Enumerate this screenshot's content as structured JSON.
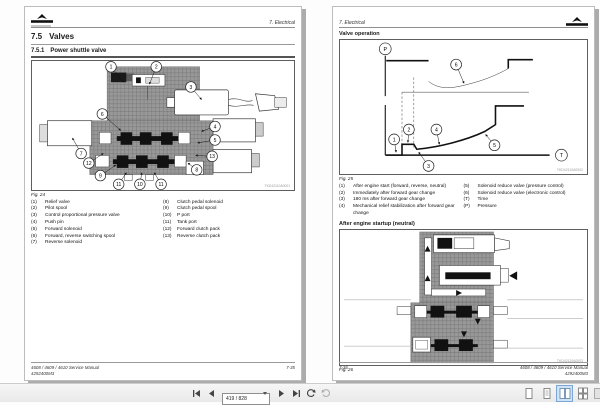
{
  "toolbar": {
    "page_input": "419 / 828"
  },
  "left_page": {
    "header": "7. Electrical",
    "section_num": "7.5",
    "section_title": "Valves",
    "subsection_num": "7.5.1",
    "subsection_title": "Power shuttle valve",
    "figure": {
      "caption": "Fig. 24",
      "drawing_id": "TKD42110A0001",
      "callouts": [
        "1",
        "2",
        "3",
        "4",
        "5",
        "6",
        "7",
        "8",
        "9",
        "10",
        "11",
        "12",
        "13"
      ]
    },
    "legend_left": [
      {
        "num": "(1)",
        "text": "Relief valve"
      },
      {
        "num": "(2)",
        "text": "Pilot spool"
      },
      {
        "num": "(3)",
        "text": "Control proportional pressure valve"
      },
      {
        "num": "(4)",
        "text": "Push pin"
      },
      {
        "num": "(5)",
        "text": "Forward solenoid"
      },
      {
        "num": "(6)",
        "text": "Forward, reverse switching spool"
      },
      {
        "num": "(7)",
        "text": "Reverse solenoid"
      }
    ],
    "legend_right": [
      {
        "num": "(8)",
        "text": "Clutch pedal solenoid"
      },
      {
        "num": "(9)",
        "text": "Clutch pedal spool"
      },
      {
        "num": "(10)",
        "text": "P port"
      },
      {
        "num": "(11)",
        "text": "Tank port"
      },
      {
        "num": "(12)",
        "text": "Forward clutch pack"
      },
      {
        "num": "(13)",
        "text": "Reverse clutch pack"
      }
    ],
    "footer": {
      "manual": "4608 / 4609 / 4610 Service Manual",
      "code": "4292400M3",
      "page_no": "7-35"
    }
  },
  "right_page": {
    "header": "7. Electrical",
    "heading_valve_operation": "Valve operation",
    "chart": {
      "caption": "Fig. 25",
      "drawing_id": "TKD42110A0002",
      "y_axis": "P",
      "x_axis": "T",
      "callouts": [
        "1",
        "2",
        "3",
        "4",
        "5",
        "6"
      ]
    },
    "legend_left": [
      {
        "num": "(1)",
        "text": "After engine start (forward, reverse, neutral)"
      },
      {
        "num": "(2)",
        "text": "Immediately after forward gear change"
      },
      {
        "num": "(3)",
        "text": "180 ms after forward gear change"
      },
      {
        "num": "(4)",
        "text": "Mechanical relief stabilization after forward gear change"
      }
    ],
    "legend_right": [
      {
        "num": "(5)",
        "text": "Solenoid reduce valve (pressure control)"
      },
      {
        "num": "(6)",
        "text": "Solenoid reduce valve (electronic control)"
      },
      {
        "num": "(T)",
        "text": "Time"
      },
      {
        "num": "(P)",
        "text": "Pressure"
      }
    ],
    "heading_after_startup": "After engine startup (neutral)",
    "figure2": {
      "caption": "Fig. 26",
      "drawing_id": "TKD42110A0003"
    },
    "footer": {
      "page_no": "7-36",
      "manual": "4608 / 4609 / 4610 Service Manual",
      "code": "4292400M3"
    }
  },
  "chart_data": {
    "type": "line",
    "title": "Valve operation - clutch pressure vs time (Fig. 25)",
    "xlabel": "T (Time)",
    "ylabel": "P (Pressure)",
    "axes_unlabeled": true,
    "x_range_relative": [
      0,
      100
    ],
    "y_range_relative": [
      0,
      100
    ],
    "series": [
      {
        "name": "Solenoid reduce valve (electronic control) (6)",
        "points": [
          [
            1,
            97
          ],
          [
            26,
            97
          ],
          [
            26,
            72
          ],
          [
            35,
            66
          ],
          [
            55,
            72
          ],
          [
            74,
            88
          ],
          [
            75,
            97
          ],
          [
            89,
            97
          ]
        ]
      },
      {
        "name": "Command reference level (thin line)",
        "points": [
          [
            10,
            62
          ],
          [
            87,
            62
          ]
        ]
      },
      {
        "name": "Solenoid reduce valve (pressure control) (5)",
        "points": [
          [
            1,
            0
          ],
          [
            10,
            0
          ],
          [
            10,
            11
          ],
          [
            17,
            11
          ],
          [
            19,
            6
          ],
          [
            45,
            13
          ],
          [
            60,
            23
          ],
          [
            67,
            31
          ],
          [
            68,
            50
          ],
          [
            83,
            50
          ]
        ]
      }
    ],
    "annotations": [
      {
        "label": "1",
        "meaning": "After engine start (forward, reverse, neutral)"
      },
      {
        "label": "2",
        "meaning": "Immediately after forward gear change"
      },
      {
        "label": "3",
        "meaning": "180 ms after forward gear change"
      },
      {
        "label": "4",
        "meaning": "Mechanical relief stabilization after forward gear change"
      },
      {
        "label": "5",
        "meaning": "Solenoid reduce valve (pressure control)"
      },
      {
        "label": "6",
        "meaning": "Solenoid reduce valve (electronic control)"
      }
    ],
    "features": [
      "y-axis drawn with a break",
      "two dashed vertical event markers",
      "axis labels P and T in circles"
    ],
    "legend_position": "numbered list below figure"
  }
}
